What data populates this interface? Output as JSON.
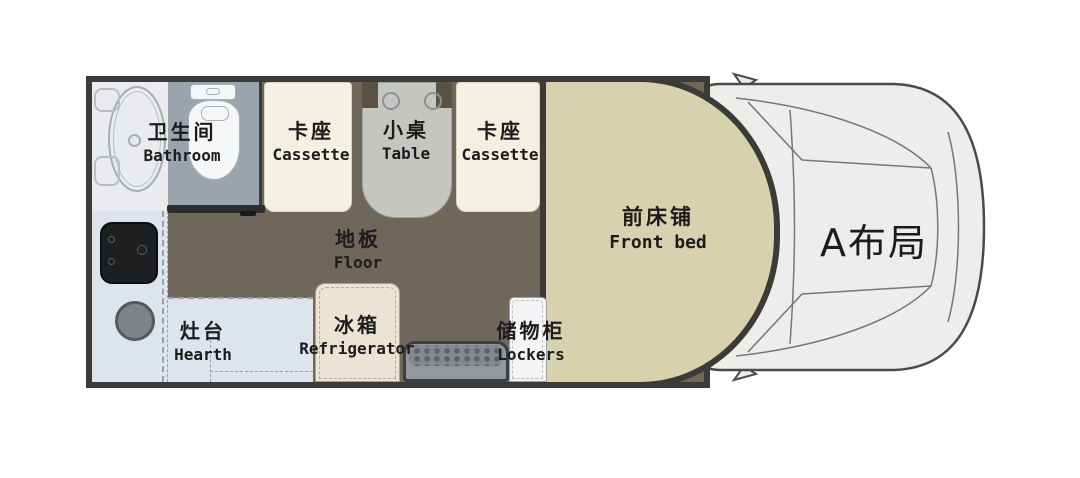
{
  "layout_badge": "A布局",
  "areas": {
    "bathroom": {
      "zh": "卫生间",
      "en": "Bathroom"
    },
    "cassette_left": {
      "zh": "卡座",
      "en": "Cassette"
    },
    "table": {
      "zh": "小桌",
      "en": "Table"
    },
    "cassette_right": {
      "zh": "卡座",
      "en": "Cassette"
    },
    "front_bed": {
      "zh": "前床铺",
      "en": "Front bed"
    },
    "floor": {
      "zh": "地板",
      "en": "Floor"
    },
    "hearth": {
      "zh": "灶台",
      "en": "Hearth"
    },
    "refrigerator": {
      "zh": "冰箱",
      "en": "Refrigerator"
    },
    "lockers": {
      "zh": "储物柜",
      "en": "Lockers"
    }
  },
  "fixtures": [
    "shower-tray-icon",
    "toilet-icon",
    "table-cupholder-icon",
    "stove-icon",
    "sink-icon",
    "entry-step-icon",
    "vehicle-cab-icon",
    "side-mirror-icon"
  ],
  "colors": {
    "wall": "#3b3b38",
    "floor": "#6f675a",
    "bed": "#d8d1ad",
    "seat": "#f3efe2",
    "seat_border": "#d9d4c4",
    "table": "#c4c6c1",
    "table_accent": "#5b5244",
    "shower_bg": "#e9ebee",
    "toilet_bg": "#9ba4ad",
    "fixture_white": "#f4f6f8",
    "counter": "#dde4ec",
    "stove": "#1d1f21",
    "sink": "#7e8387",
    "sink_border": "#55595c",
    "fridge": "#ebe4d3",
    "fridge_border": "#a89f8d",
    "step": "#94989c",
    "step_border": "#3c3f42",
    "step_dot": "#5f646a",
    "lockers": "#f3f4f6",
    "lockers_border": "#9aa0a6",
    "cab": "#ededeb",
    "cab_line": "#4b4b49",
    "cab_line_soft": "#77777a",
    "door": "#2c2d2e",
    "dashed": "#9aa0a8",
    "text": "#1c1c1c"
  }
}
